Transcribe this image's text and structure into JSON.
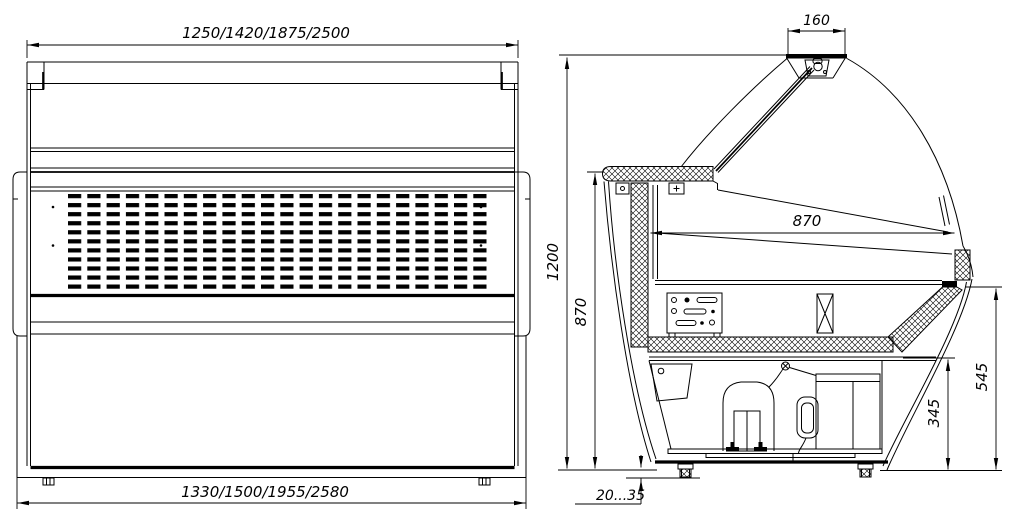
{
  "colors": {
    "background": "#ffffff",
    "line": "#000000"
  },
  "views": {
    "front": {
      "title": "front-view",
      "dims": {
        "top_lengths": "1250/1420/1875/2500",
        "bottom_lengths": "1330/1500/1955/2580"
      }
    },
    "side": {
      "title": "side-view",
      "dims": {
        "canopy_width": "160",
        "overall_height": "1200",
        "worktop_height": "870",
        "display_depth": "870",
        "front_glass_bottom_height": "545",
        "lower_panel_height": "345",
        "leg_adjust_range": "20...35"
      }
    }
  }
}
